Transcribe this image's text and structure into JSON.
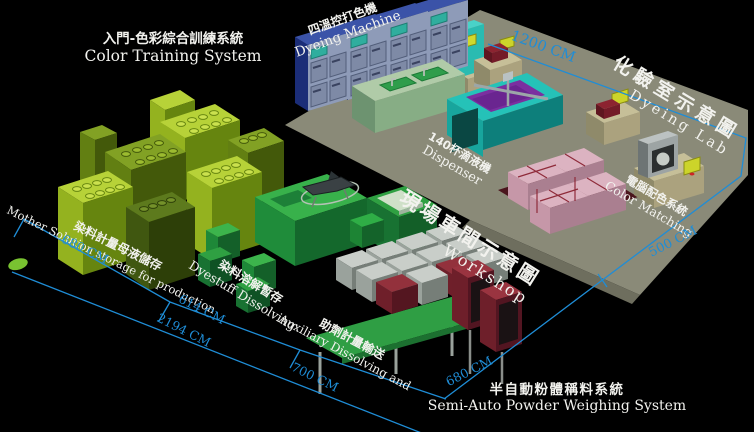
{
  "labels": {
    "training": {
      "zh": "入門-色彩綜合訓練系統",
      "en": "Color Training System"
    },
    "dyeing_machine": {
      "zh": "四溫控打色機",
      "en": "Dyeing Machine"
    },
    "dyeing_lab": {
      "zh": "化驗室示意圖",
      "en": "Dyeing  Lab"
    },
    "dispenser": {
      "zh": "140杯滴液機",
      "en": "Dispenser"
    },
    "workshop": {
      "zh": "現場車間示意圖",
      "en": "Workshop"
    },
    "color_matching": {
      "zh": "電腦配色系統",
      "en": "Color Matching"
    },
    "mother_solution": {
      "zh": "染料計量母液儲存",
      "en": "Mother Solution storage for production"
    },
    "dyestuff_dissolving": {
      "zh": "染料溶解暫存",
      "en": "Dyestuff Dissolving"
    },
    "auxiliary": {
      "zh": "助劑計量輸送",
      "en": "Auxiliary Dissolving and"
    },
    "powder_weighing": {
      "zh": "半自動粉體稱料系統",
      "en": "Semi-Auto Powder Weighing System"
    }
  },
  "dimensions": {
    "lab_length": "1200 CM",
    "lab_depth": "500 CM",
    "storage_length": "680 CM",
    "dissolving_length": "614 CM",
    "total_length": "2194 CM",
    "auxiliary_length": "700 CM",
    "weighing_length": "680 CM"
  },
  "colors": {
    "background": "#000000",
    "dimension_blue": "#1f8dd6",
    "label_white": "#f2f2ee",
    "lab_floor_olive": "#8a8a78",
    "dyeing_machine_blue": "#8e9bb8",
    "dispenser_teal": "#25c2b8",
    "dispenser_purple": "#7b2fa0",
    "storage_chartreuse": "#b7d238",
    "dissolving_green": "#38b14b",
    "fabric_pink": "#dcb3c1",
    "cabinet_red": "#9a3440",
    "screen_yellow": "#d6d92c"
  }
}
